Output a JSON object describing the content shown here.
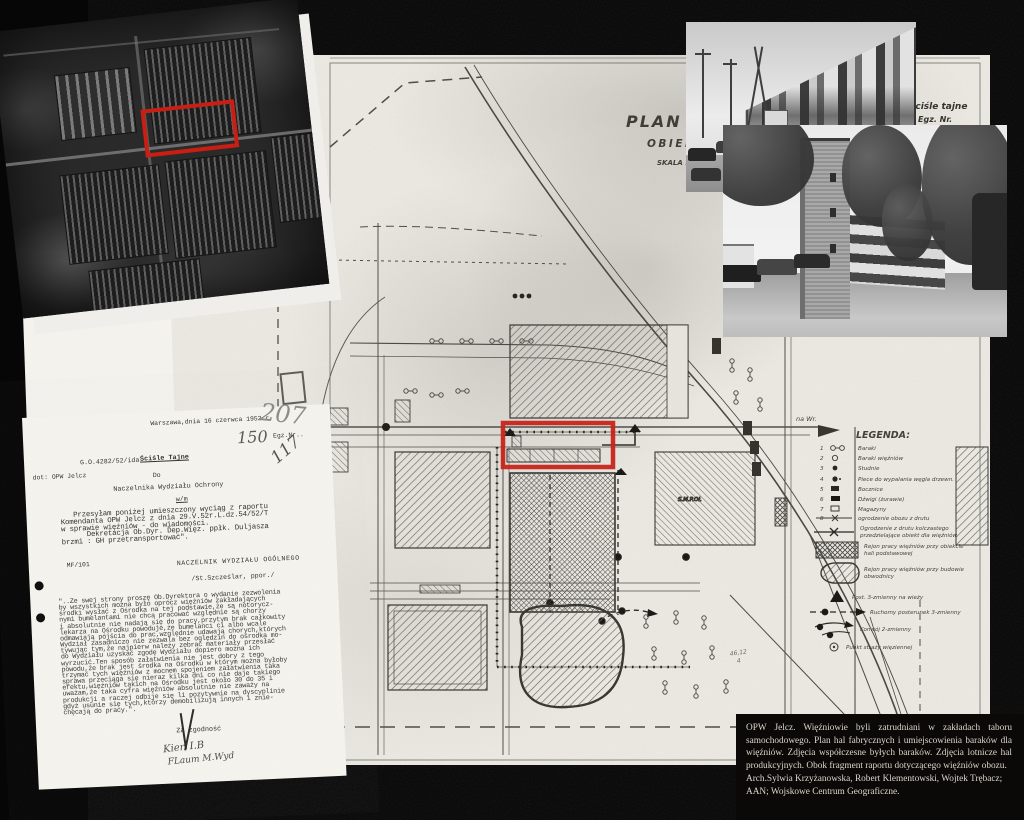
{
  "colors": {
    "annotation_red": "#c81e14",
    "paper": "#ebe9e2",
    "background": "#060606"
  },
  "plan": {
    "title_line1": "PLAN SYTU",
    "title_line2": "OBIEKTU",
    "title_line3": "SKALA 1:",
    "stamp_line1": "ściśle tajne",
    "stamp_line2": "Egz. Nr.",
    "route_label": "na Wr.",
    "building_label": "S.M.P.Oł.",
    "note": "46,12",
    "legend": {
      "title": "LEGENDA:",
      "items": [
        {
          "num": "1",
          "label": "Baraki"
        },
        {
          "num": "2",
          "label": "Baraki więźniów"
        },
        {
          "num": "3",
          "label": "Studnie"
        },
        {
          "num": "4",
          "label": "Piece do wypalania węgla drzewn."
        },
        {
          "num": "5",
          "label": "Bocznice"
        },
        {
          "num": "6",
          "label": "Dźwigi (żurawie)"
        },
        {
          "num": "7",
          "label": "Magazyny"
        },
        {
          "num": "8",
          "label": "ogrodzenie obozu z drutu"
        }
      ],
      "fence_label_1": "Ogrodzenie z drutu kolczastego",
      "fence_label_2": "przedzielające obiekt dla więźniów",
      "area1_label_1": "Rejon pracy więźniów przy obiekcie",
      "area1_label_2": "hali podstawowej",
      "area2_label_1": "Rejon pracy więźniów przy budowie",
      "area2_label_2": "obwodnicy",
      "post_tower_label": "Post. 3-zmienny na wieży",
      "post_mobile_label": "Ruchomy posterunek 3-zmienny",
      "convoy_label": "Konwój 2-zmienny",
      "guard_label": "Punkt straży więziennej"
    }
  },
  "letter": {
    "date_line": "Warszawa,dnia 16 czerwca 1952 r.",
    "egz": "Egz.Nr..",
    "ref": "G.O.4282/52/ida",
    "re": "dot: OPW Jelcz",
    "secret": "Ściśle Tajne",
    "to": "Do",
    "recipient": "Naczelnika Wydziału Ochrony",
    "wm": "w/m",
    "body": "   Przesyłam poniżej umieszczony wyciąg z raportu\nKomendanta OPW Jelcz z dnia 29.V.52r.L.dz.54/52/T\nw sprawie więźniów - do wiadomości.\n      Dekretacja Ob.Dyr. Dep.Więz. ppłk. Duljasza\nbrzmi : GH przetransportować\".",
    "initials": "MF/101",
    "signer_title": "NACZELNIK WYDZIAŁU OGÓLNEGO",
    "signer": "/St.Szcześlar, ppor./",
    "quote": "\"..Ze swej strony proszę Ob.Dyrektora o wydanie zezwolenia\nby wszystkich można było oprócz więźniów zakładających\nśrodki wysłać z Ośrodka na tej podstawie,że są notorycz-\nnymi bumelantami nie chcą pracować względnie są chorzy\ni absolutnie nie nadają się do pracy,przytym brak całkowity\nlekarza na Ośrodku powoduje,że bumelanci ci albo wcale\nodmawiają pójścia do prac,względnie udawają chorych,których\nWydział zasadniczo nie zezwala bez oględzin do ośrodka mo-\ntywując tym,że najpierw należy zebrać materiały przesłać\ndo Wydziału uzyskać zgodę Wydziału dopiero można ich\nwyrzucić.Ten sposób załatwienia nie jest dobry z tego\npowodu,że brak jest środka na Ośrodku w którym można byłoby\ntrzymać tych więźniów z mocnem spojeniem załatwienia taka\nsprawa przeciąga się nieraz kilka dni co nie daje takiego\nefektu,więźniów takich na Ośrodku jest około 30 do 35 i\nuważam,że taka cyfra więźniów absolutnie nie zaważy na\nprodukcji a raczej odbije się li pozytywnie na dyscyplinie\ngdyż usunie się tych,którzy demobilizują innych i znie-\nchęcają do pracy.\".",
    "certify": "Za zgodność",
    "hand_207": "207",
    "hand_160": "150",
    "hand_117": "117",
    "hand_sig1": "Kier. I.B",
    "hand_sig2": "FLaum M.Wyd"
  },
  "caption": {
    "line1": "OPW Jelcz. Więźniowie byli zatrudniani w zakładach taboru samochodowego.",
    "line2": "Plan hal fabrycznych i umiejscowienia baraków dla więźniów. Zdjęcia współczesne",
    "line3": "byłych baraków. Zdjęcia lotnicze hal produkcyjnych. Obok fragment raportu",
    "line4": "dotyczącego więźniów obozu.",
    "line5": "Arch.Sylwia Krzyżanowska, Robert Klementowski, Wojtek Trębacz; AAN; Wojskowe",
    "line6": "Centrum Geograficzne."
  }
}
